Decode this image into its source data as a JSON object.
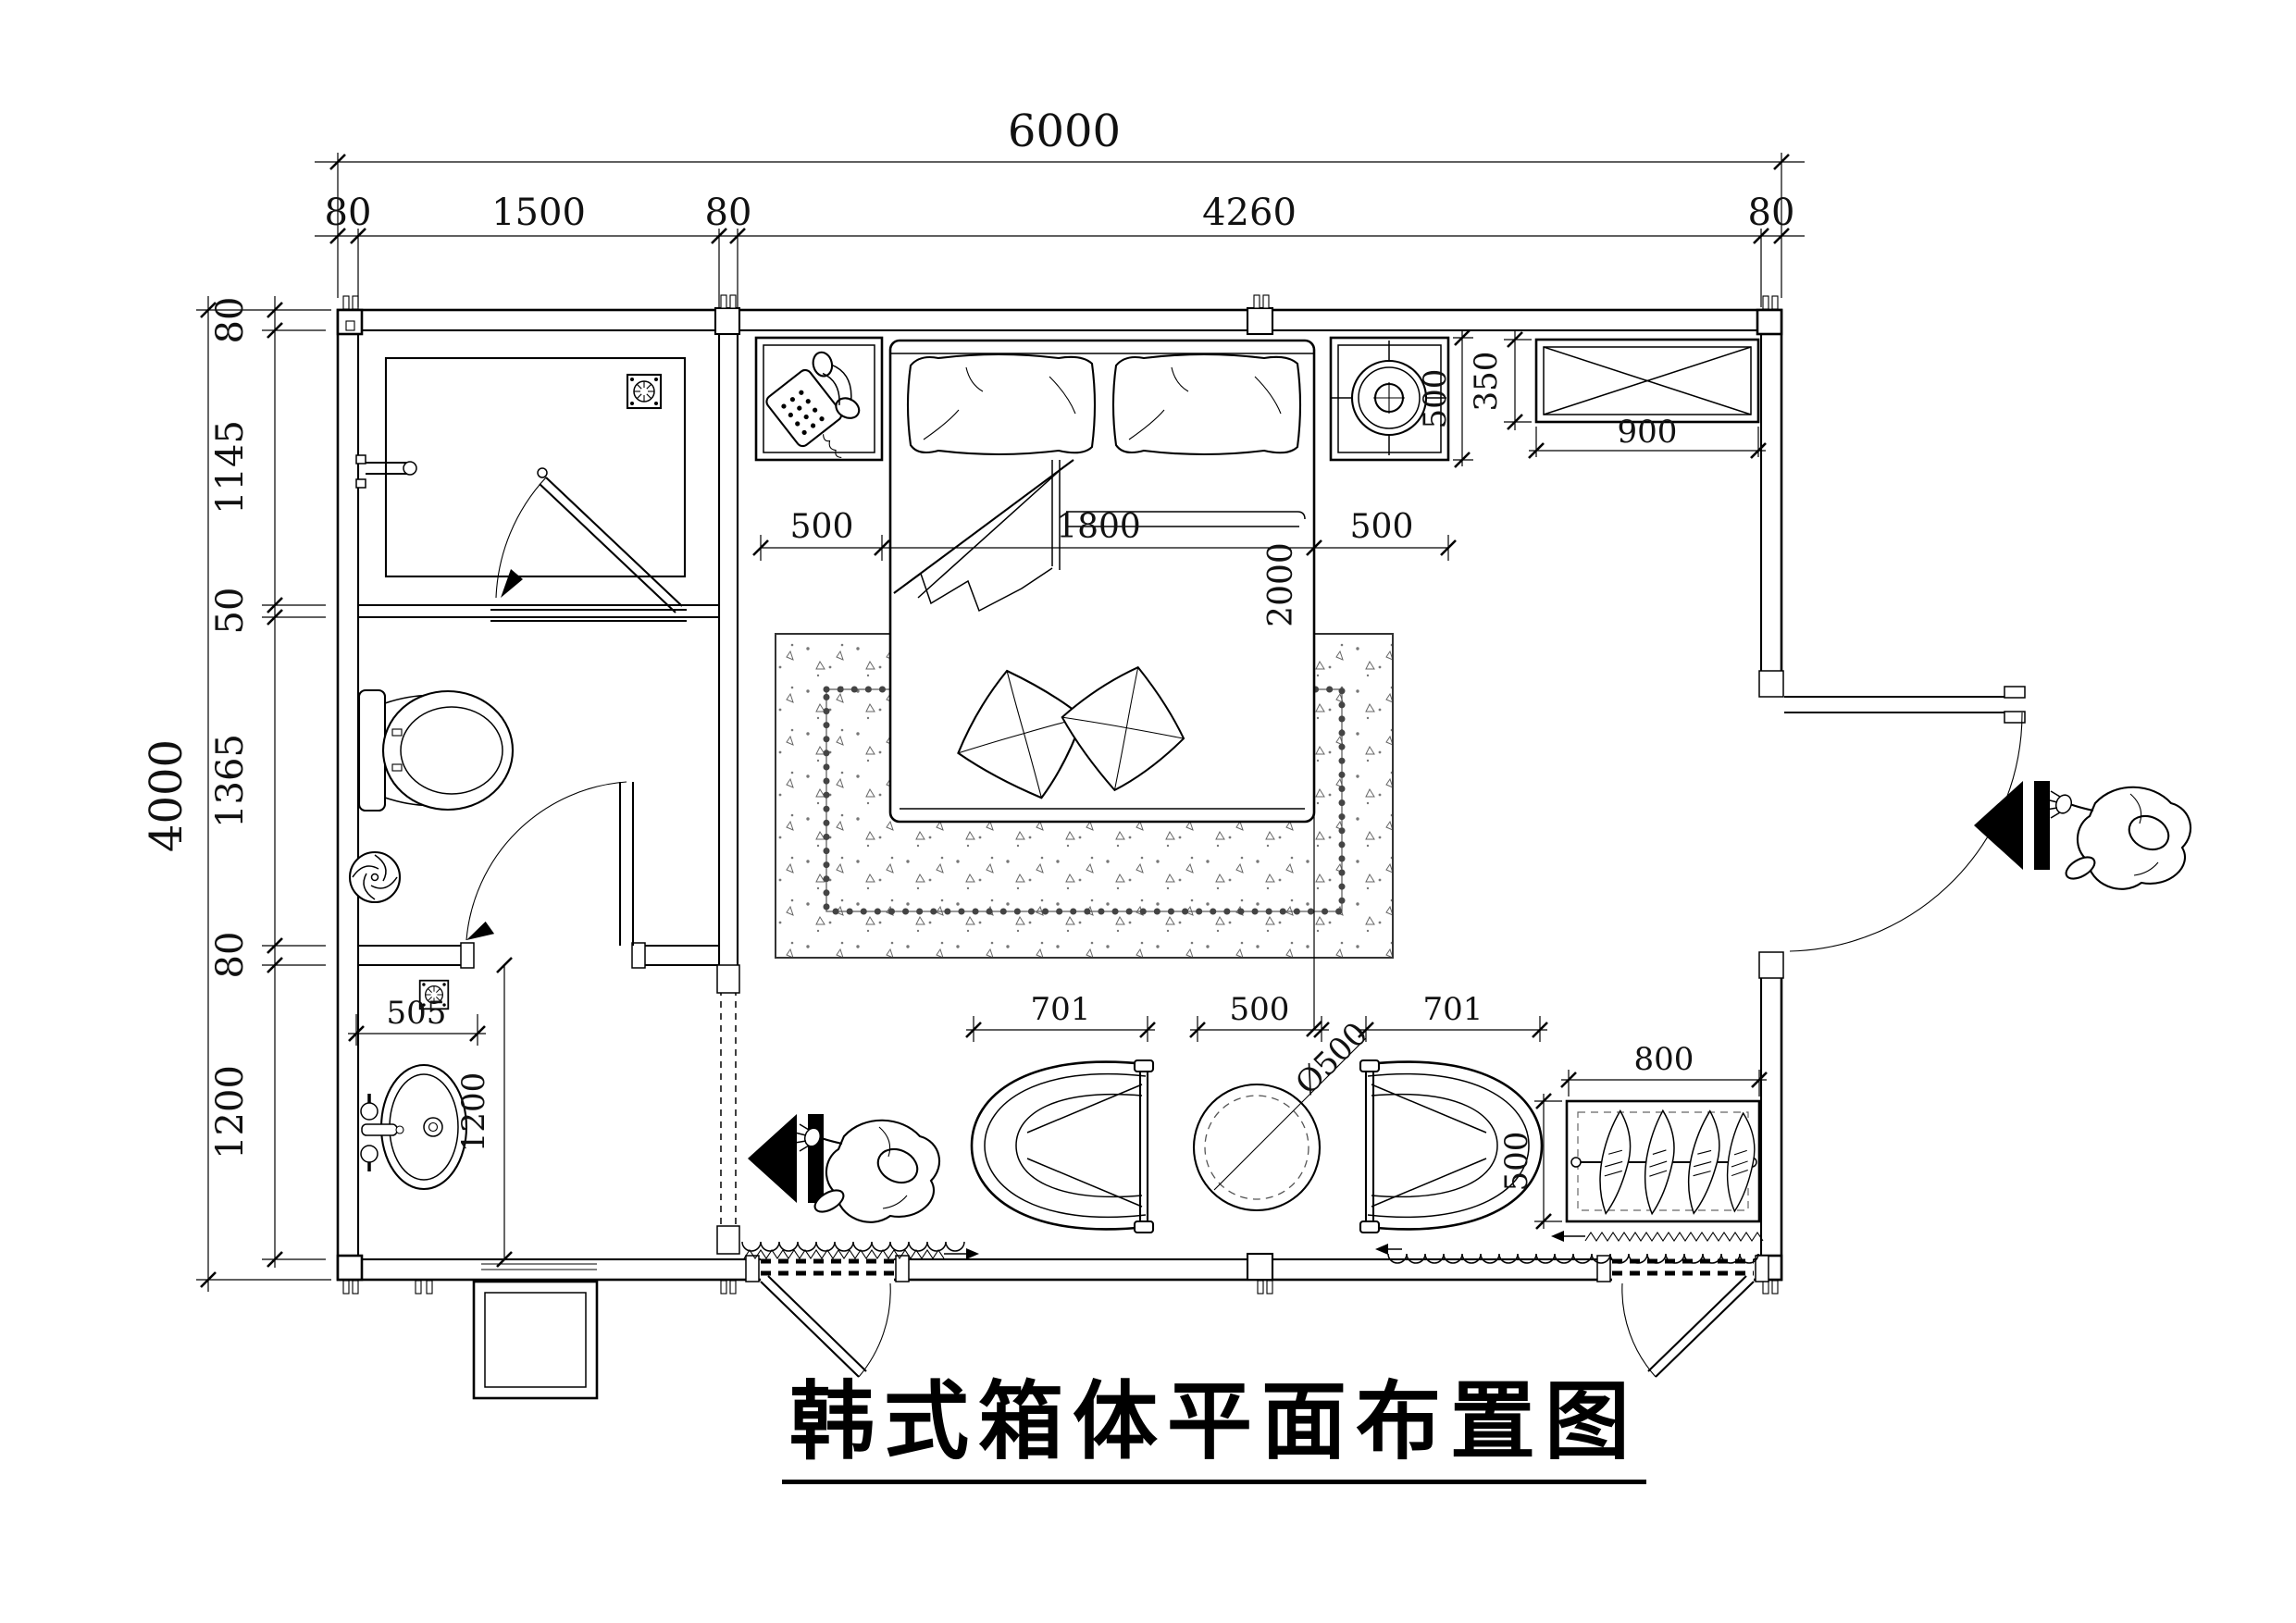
{
  "title": "韩式箱体平面布置图",
  "dims": {
    "overall_w": "6000",
    "overall_h": "4000",
    "top": [
      "80",
      "1500",
      "80",
      "4260",
      "80"
    ],
    "left": [
      "80",
      "1145",
      "50",
      "1365",
      "80",
      "1200"
    ],
    "bed_left_gap": "500",
    "bed_width": "1800",
    "bed_right_gap": "500",
    "bed_length": "2000",
    "nightstand_depth": "500",
    "window_height": "350",
    "window_width": "900",
    "drain_offset": "505",
    "vanity_length": "1200",
    "chair_left": "701",
    "table_gap": "500",
    "chair_right": "701",
    "table_diameter": "Ø500",
    "planter_width": "800",
    "planter_depth": "500"
  }
}
